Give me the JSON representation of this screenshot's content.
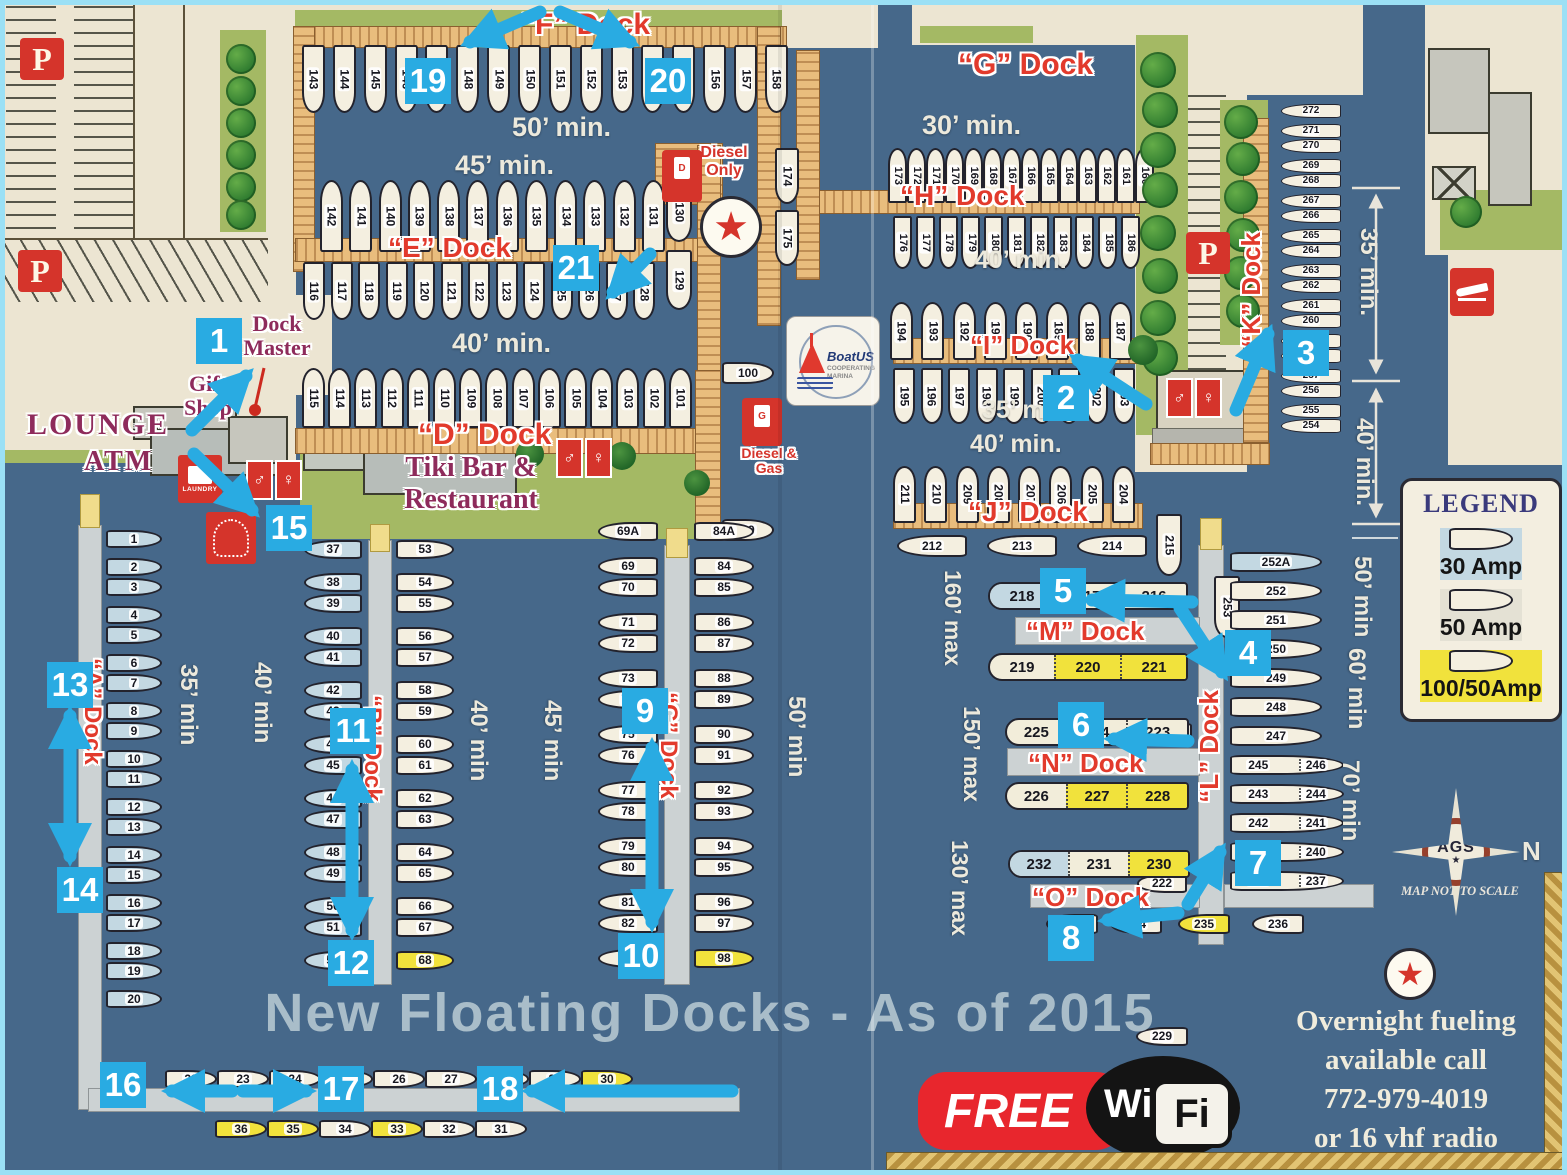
{
  "map": {
    "parking_label": "P",
    "docks": {
      "f": {
        "label": "“F” Dock",
        "min1": "50’ min.",
        "min2": "45’ min.",
        "slips": [
          {
            "n": "143"
          },
          {
            "n": "144"
          },
          {
            "n": "145"
          },
          {
            "n": "146"
          },
          {
            "n": "147"
          },
          {
            "n": "148"
          },
          {
            "n": "149"
          },
          {
            "n": "150"
          },
          {
            "n": "151"
          },
          {
            "n": "152"
          },
          {
            "n": "153"
          },
          {
            "n": "154"
          },
          {
            "n": "155"
          },
          {
            "n": "156"
          },
          {
            "n": "157"
          },
          {
            "n": "158"
          }
        ]
      },
      "e": {
        "label": "“E” Dock",
        "upper": [
          {
            "n": "142"
          },
          {
            "n": "141"
          },
          {
            "n": "140"
          },
          {
            "n": "139"
          },
          {
            "n": "138"
          },
          {
            "n": "137"
          },
          {
            "n": "136"
          },
          {
            "n": "135"
          },
          {
            "n": "134"
          },
          {
            "n": "133"
          },
          {
            "n": "132"
          },
          {
            "n": "131"
          }
        ],
        "lower": [
          {
            "n": "116"
          },
          {
            "n": "117"
          },
          {
            "n": "118"
          },
          {
            "n": "119"
          },
          {
            "n": "120"
          },
          {
            "n": "121"
          },
          {
            "n": "122"
          },
          {
            "n": "123"
          },
          {
            "n": "124"
          },
          {
            "n": "125"
          },
          {
            "n": "126"
          },
          {
            "n": "127"
          },
          {
            "n": "128"
          }
        ],
        "right": [
          {
            "n": "130"
          },
          {
            "n": "129"
          }
        ]
      },
      "d": {
        "label": "“D” Dock",
        "min": "40’ min.",
        "end100": "100",
        "end99": "99",
        "slips": [
          {
            "n": "115"
          },
          {
            "n": "114"
          },
          {
            "n": "113"
          },
          {
            "n": "112"
          },
          {
            "n": "111"
          },
          {
            "n": "110"
          },
          {
            "n": "109"
          },
          {
            "n": "108"
          },
          {
            "n": "107"
          },
          {
            "n": "106"
          },
          {
            "n": "105"
          },
          {
            "n": "104"
          },
          {
            "n": "103"
          },
          {
            "n": "102"
          },
          {
            "n": "101"
          }
        ]
      },
      "g": {
        "label": "“G” Dock",
        "min": "30’ min."
      },
      "h": {
        "label": "“H” Dock",
        "min": "40’ min.",
        "left": [
          {
            "n": "174"
          },
          {
            "n": "175"
          }
        ],
        "top": [
          {
            "n": "173"
          },
          {
            "n": "172"
          },
          {
            "n": "171"
          },
          {
            "n": "170"
          },
          {
            "n": "169"
          },
          {
            "n": "168"
          },
          {
            "n": "167"
          },
          {
            "n": "166"
          },
          {
            "n": "165"
          },
          {
            "n": "164"
          },
          {
            "n": "163"
          },
          {
            "n": "162"
          },
          {
            "n": "161"
          },
          {
            "n": "160"
          }
        ],
        "bottom": [
          {
            "n": "176"
          },
          {
            "n": "177"
          },
          {
            "n": "178"
          },
          {
            "n": "179"
          },
          {
            "n": "180"
          },
          {
            "n": "181"
          },
          {
            "n": "182"
          },
          {
            "n": "183"
          },
          {
            "n": "184"
          },
          {
            "n": "185"
          },
          {
            "n": "186"
          }
        ]
      },
      "i": {
        "label": "“I” Dock",
        "min1": "35’ min.",
        "min2": "40’ min.",
        "top": [
          {
            "n": "194"
          },
          {
            "n": "193"
          },
          {
            "n": "192"
          },
          {
            "n": "191"
          },
          {
            "n": "190"
          },
          {
            "n": "189"
          },
          {
            "n": "188"
          },
          {
            "n": "187"
          }
        ],
        "bottom": [
          {
            "n": "195"
          },
          {
            "n": "196"
          },
          {
            "n": "197"
          },
          {
            "n": "198"
          },
          {
            "n": "199"
          },
          {
            "n": "200"
          },
          {
            "n": "201"
          },
          {
            "n": "202"
          },
          {
            "n": "203"
          }
        ]
      },
      "j": {
        "label": "“J” Dock",
        "top": [
          {
            "n": "211"
          },
          {
            "n": "210"
          },
          {
            "n": "209"
          },
          {
            "n": "208"
          },
          {
            "n": "207"
          },
          {
            "n": "206"
          },
          {
            "n": "205"
          },
          {
            "n": "204"
          }
        ],
        "bottom": [
          {
            "n": "212"
          },
          {
            "n": "213"
          },
          {
            "n": "214"
          }
        ]
      },
      "k": {
        "label": "“K” Dock",
        "min1": "35’ min.",
        "min2": "40’ min.",
        "slips": [
          {
            "n": "272"
          },
          {
            "n": "271",
            "mt": 5
          },
          {
            "n": "270"
          },
          {
            "n": "269",
            "mt": 5
          },
          {
            "n": "268"
          },
          {
            "n": "267",
            "mt": 5
          },
          {
            "n": "266"
          },
          {
            "n": "265",
            "mt": 5
          },
          {
            "n": "264"
          },
          {
            "n": "263",
            "mt": 5
          },
          {
            "n": "262"
          },
          {
            "n": "261",
            "mt": 5
          },
          {
            "n": "260"
          },
          {
            "n": "259",
            "mt": 5
          },
          {
            "n": "258"
          },
          {
            "n": "257",
            "mt": 5
          },
          {
            "n": "256"
          },
          {
            "n": "255",
            "mt": 5
          },
          {
            "n": "254"
          }
        ]
      },
      "l": {
        "label": "“L” Dock",
        "min1": "50’ min",
        "min2": "60’ min",
        "min3": "70’ min",
        "slips": [
          {
            "n": "252A",
            "c": "b"
          },
          {
            "n": "252"
          },
          {
            "n": "251"
          },
          {
            "n": "250"
          },
          {
            "n": "249"
          },
          {
            "n": "248"
          },
          {
            "n": "247"
          },
          {
            "n": "245",
            "n2": "246",
            "c": "pair"
          },
          {
            "n": "243",
            "n2": "244",
            "c": "pair"
          },
          {
            "n": "242",
            "n2": "241",
            "c": "pair"
          },
          {
            "n": "239",
            "n2": "240",
            "c": "pair"
          },
          {
            "n": "238",
            "n2": "237",
            "c": "pair"
          }
        ]
      },
      "m": {
        "label": "“M” Dock",
        "max": "160’ max",
        "a": "216A",
        "s222": "222",
        "row1": [
          {
            "n": "218",
            "c": "b"
          },
          {
            "n": "217"
          },
          {
            "n": "216"
          }
        ],
        "row2": [
          {
            "n": "219"
          },
          {
            "n": "220",
            "c": "y"
          },
          {
            "n": "221",
            "c": "y"
          }
        ]
      },
      "n": {
        "label": "“N” Dock",
        "max": "150’ max",
        "row1": [
          {
            "n": "225"
          },
          {
            "n": "224"
          },
          {
            "n": "223"
          }
        ],
        "row2": [
          {
            "n": "226"
          },
          {
            "n": "227",
            "c": "y"
          },
          {
            "n": "228",
            "c": "y"
          }
        ]
      },
      "o": {
        "label": "“O” Dock",
        "max": "130’ max",
        "s229": "229",
        "row1": [
          {
            "n": "232",
            "c": "b"
          },
          {
            "n": "231"
          },
          {
            "n": "230",
            "c": "y"
          }
        ],
        "row2": [
          {
            "n": "233"
          },
          {
            "n": "234",
            "ml": 12
          },
          {
            "n": "235",
            "c": "y",
            "ml": 16
          },
          {
            "n": "236",
            "ml": 22
          }
        ]
      },
      "a": {
        "label": "“A” Dock",
        "min": "35’ min",
        "min_ab": "40’ min",
        "slips": [
          {
            "n": "1"
          },
          {
            "n": "2",
            "mt": 8
          },
          {
            "n": "3"
          },
          {
            "n": "4",
            "mt": 8
          },
          {
            "n": "5"
          },
          {
            "n": "6",
            "mt": 8
          },
          {
            "n": "7"
          },
          {
            "n": "8",
            "mt": 8
          },
          {
            "n": "9"
          },
          {
            "n": "10",
            "mt": 8
          },
          {
            "n": "11"
          },
          {
            "n": "12",
            "mt": 8
          },
          {
            "n": "13"
          },
          {
            "n": "14",
            "mt": 8
          },
          {
            "n": "15"
          },
          {
            "n": "16",
            "mt": 8
          },
          {
            "n": "17"
          },
          {
            "n": "18",
            "mt": 8
          },
          {
            "n": "19"
          },
          {
            "n": "20",
            "mt": 8
          }
        ]
      },
      "b": {
        "label": "“B” Dock",
        "min": "40’ min",
        "min_bc": "45’ min",
        "left": [
          {
            "n": "37"
          },
          {
            "n": "38",
            "mt": 12
          },
          {
            "n": "39"
          },
          {
            "n": "40",
            "mt": 12
          },
          {
            "n": "41"
          },
          {
            "n": "42",
            "mt": 12
          },
          {
            "n": "43"
          },
          {
            "n": "44",
            "mt": 12
          },
          {
            "n": "45"
          },
          {
            "n": "46",
            "mt": 12
          },
          {
            "n": "47"
          },
          {
            "n": "48",
            "mt": 12
          },
          {
            "n": "49"
          },
          {
            "n": "50",
            "mt": 12
          },
          {
            "n": "51"
          },
          {
            "n": "52",
            "mt": 12
          }
        ],
        "right": [
          {
            "n": "53"
          },
          {
            "n": "54",
            "mt": 12
          },
          {
            "n": "55"
          },
          {
            "n": "56",
            "mt": 12
          },
          {
            "n": "57"
          },
          {
            "n": "58",
            "mt": 12
          },
          {
            "n": "59"
          },
          {
            "n": "60",
            "mt": 12
          },
          {
            "n": "61"
          },
          {
            "n": "62",
            "mt": 12
          },
          {
            "n": "63"
          },
          {
            "n": "64",
            "mt": 12
          },
          {
            "n": "65"
          },
          {
            "n": "66",
            "mt": 12
          },
          {
            "n": "67"
          },
          {
            "n": "68",
            "mt": 12,
            "c": "y"
          }
        ]
      },
      "c": {
        "label": "“C” Dock",
        "min": "50’ min",
        "left": [
          {
            "n": "69A"
          },
          {
            "n": "69",
            "mt": 14
          },
          {
            "n": "70"
          },
          {
            "n": "71",
            "mt": 14
          },
          {
            "n": "72"
          },
          {
            "n": "73",
            "mt": 14
          },
          {
            "n": "74"
          },
          {
            "n": "75",
            "mt": 14
          },
          {
            "n": "76"
          },
          {
            "n": "77",
            "mt": 14
          },
          {
            "n": "78"
          },
          {
            "n": "79",
            "mt": 14
          },
          {
            "n": "80"
          },
          {
            "n": "81",
            "mt": 14
          },
          {
            "n": "82"
          },
          {
            "n": "83",
            "mt": 14
          }
        ],
        "right": [
          {
            "n": "84A"
          },
          {
            "n": "84",
            "mt": 14
          },
          {
            "n": "85"
          },
          {
            "n": "86",
            "mt": 14
          },
          {
            "n": "87"
          },
          {
            "n": "88",
            "mt": 14
          },
          {
            "n": "89"
          },
          {
            "n": "90",
            "mt": 14
          },
          {
            "n": "91"
          },
          {
            "n": "92",
            "mt": 14
          },
          {
            "n": "93"
          },
          {
            "n": "94",
            "mt": 14
          },
          {
            "n": "95"
          },
          {
            "n": "96",
            "mt": 14
          },
          {
            "n": "97"
          },
          {
            "n": "98",
            "mt": 14,
            "c": "y"
          }
        ]
      },
      "s215": "215",
      "s253": "253",
      "row_out": [
        {
          "n": "22"
        },
        {
          "n": "23"
        },
        {
          "n": "24"
        },
        {
          "n": "25"
        },
        {
          "n": "26"
        },
        {
          "n": "27"
        },
        {
          "n": "28"
        },
        {
          "n": "29"
        },
        {
          "n": "30",
          "c": "y"
        }
      ],
      "row_in": [
        {
          "n": "36",
          "c": "y"
        },
        {
          "n": "35",
          "c": "y"
        },
        {
          "n": "34"
        },
        {
          "n": "33",
          "c": "y"
        },
        {
          "n": "32"
        },
        {
          "n": "31"
        }
      ]
    },
    "places": {
      "lounge": "LOUNGE",
      "atm": "ATM",
      "gift": "Gift Shop",
      "dock_master": "Dock Master",
      "tiki": "Tiki Bar & Restaurant",
      "diesel_only": "Diesel Only",
      "diesel_gas": "Diesel & Gas",
      "laundry": "LAUNDRY"
    },
    "icons": {
      "man": "♂",
      "woman": "♀",
      "star": "★",
      "diesel_letter": "D",
      "gas_letter": "G"
    },
    "legend": {
      "title": "LEGEND",
      "items": [
        {
          "label": "30 Amp",
          "c": "b"
        },
        {
          "label": "50 Amp",
          "c": "g"
        },
        {
          "label": "100/50Amp",
          "c": "y"
        }
      ]
    },
    "notes": {
      "title": "New Floating Docks - As of 2015",
      "fueling": [
        {
          "t": "Overnight fueling"
        },
        {
          "t": "available call"
        },
        {
          "t": "772-979-4019"
        },
        {
          "t": "or 16 vhf radio"
        }
      ],
      "scale": "MAP NOT TO SCALE",
      "north": "N",
      "compass": "AGS",
      "wifi": {
        "free": "FREE",
        "wi": "Wi",
        "fi": "Fi"
      },
      "boatus": {
        "name": "BoatUS",
        "l1": "COOPERATING",
        "l2": "MARINA"
      }
    },
    "markers": [
      {
        "n": "1",
        "x": 196,
        "y": 318
      },
      {
        "n": "2",
        "x": 1043,
        "y": 375
      },
      {
        "n": "3",
        "x": 1283,
        "y": 330
      },
      {
        "n": "4",
        "x": 1225,
        "y": 630
      },
      {
        "n": "5",
        "x": 1040,
        "y": 568
      },
      {
        "n": "6",
        "x": 1058,
        "y": 702
      },
      {
        "n": "7",
        "x": 1235,
        "y": 840
      },
      {
        "n": "8",
        "x": 1048,
        "y": 915
      },
      {
        "n": "9",
        "x": 622,
        "y": 688
      },
      {
        "n": "10",
        "x": 618,
        "y": 933
      },
      {
        "n": "11",
        "x": 330,
        "y": 708
      },
      {
        "n": "12",
        "x": 328,
        "y": 940
      },
      {
        "n": "13",
        "x": 47,
        "y": 662
      },
      {
        "n": "14",
        "x": 57,
        "y": 867
      },
      {
        "n": "15",
        "x": 266,
        "y": 505
      },
      {
        "n": "16",
        "x": 100,
        "y": 1062
      },
      {
        "n": "17",
        "x": 318,
        "y": 1066
      },
      {
        "n": "18",
        "x": 477,
        "y": 1066
      },
      {
        "n": "19",
        "x": 405,
        "y": 58
      },
      {
        "n": "20",
        "x": 645,
        "y": 58
      },
      {
        "n": "21",
        "x": 553,
        "y": 245
      }
    ]
  }
}
